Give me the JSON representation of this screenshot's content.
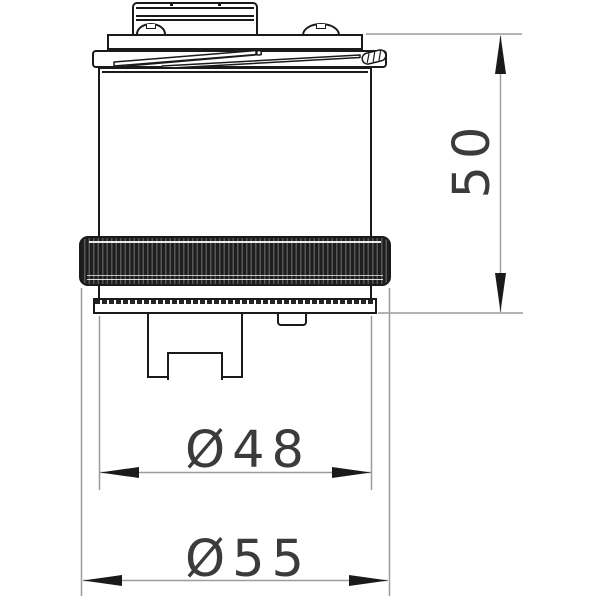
{
  "dimensions": {
    "height": {
      "label": "50"
    },
    "body_diameter": {
      "label": "Ø48"
    },
    "ring_diameter": {
      "label": "Ø55"
    }
  },
  "colors": {
    "line": "#1a1a1a",
    "dim": "#9c9c9c",
    "arrow": "#1a1a1a",
    "text": "#3b3b3b",
    "knurl-dark": "#1e1e1e",
    "knurl-light": "#565656"
  }
}
